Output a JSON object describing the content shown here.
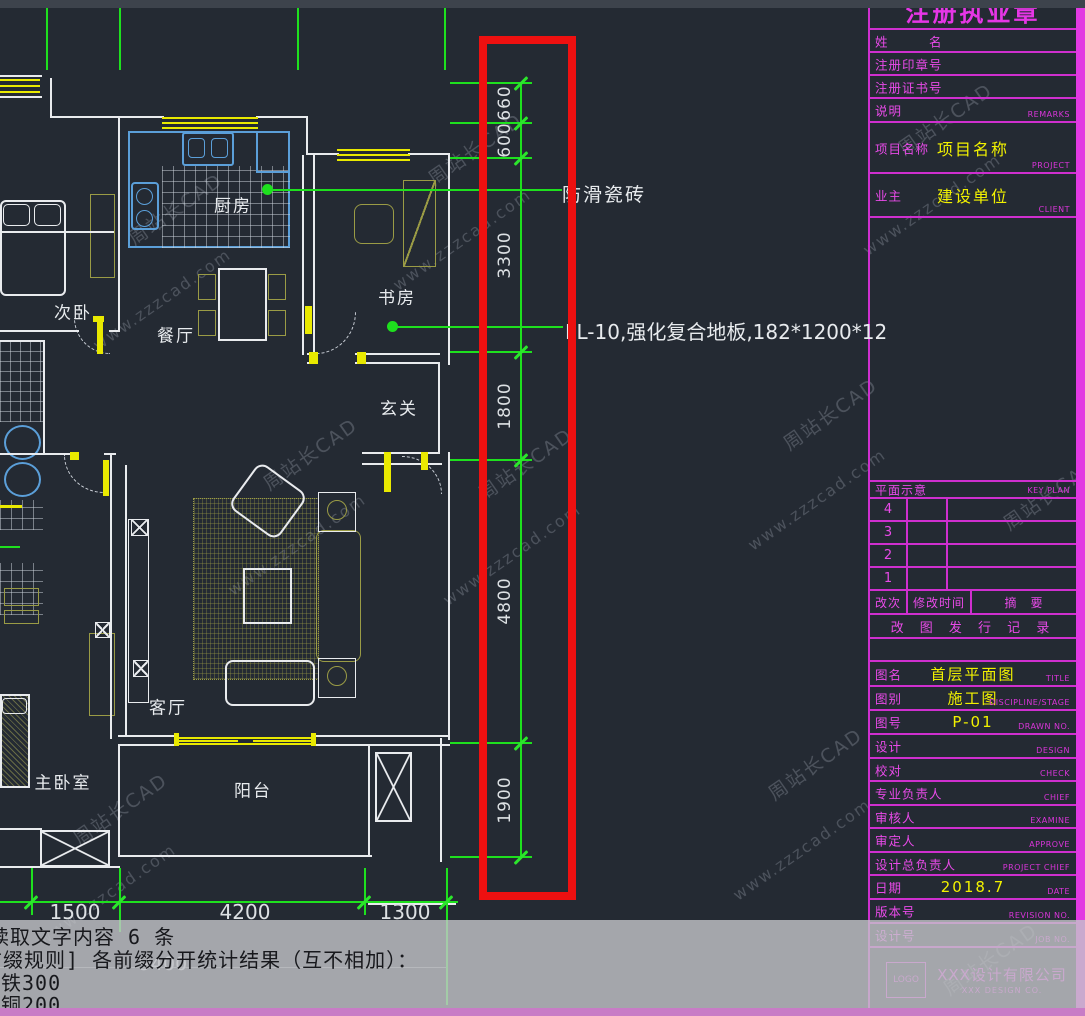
{
  "watermark": {
    "cn": "周站长CAD",
    "url": "www.zzzcad.com"
  },
  "plan": {
    "room_labels": [
      "厨房",
      "次卧",
      "餐厅",
      "书房",
      "玄关",
      "客厅",
      "主卧室",
      "阳台"
    ],
    "annotations": {
      "tile": "防滑瓷砖",
      "floor": "FL-10,强化复合地板,182*1200*12"
    }
  },
  "dims": {
    "vertical": [
      "660",
      "600",
      "3300",
      "1800",
      "4800",
      "1900"
    ],
    "bottom": [
      "1500",
      "4200",
      "1300"
    ],
    "overall": "9400"
  },
  "titleblock": {
    "header": "注册执业章",
    "name_label": "姓　　　名",
    "seal_label": "注册印章号",
    "cert_label": "注册证书号",
    "remarks_label": "说明",
    "remarks_en": "REMARKS",
    "project_label": "项目名称",
    "project_value": "项目名称",
    "project_en": "PROJECT",
    "client_label": "业主",
    "client_value": "建设单位",
    "client_en": "CLIENT",
    "keyplan_label": "平面示意",
    "keyplan_en": "KEY PLAN",
    "keyplan_rows": [
      "4",
      "3",
      "2",
      "1"
    ],
    "rev_col1": "改次",
    "rev_col2": "修改时间",
    "rev_col3": "摘　要",
    "revlog": "改 图 发 行 记 录",
    "title_label": "图名",
    "title_value": "首层平面图",
    "title_en": "TITLE",
    "stage_label": "图别",
    "stage_value": "施工图",
    "stage_en": "DISCIPLINE/STAGE",
    "dwg_label": "图号",
    "dwg_value": "P-01",
    "dwg_en": "DRAWN NO.",
    "design_label": "设计",
    "design_en": "DESIGN",
    "check_label": "校对",
    "check_en": "CHECK",
    "chief_label": "专业负责人",
    "chief_en": "CHIEF",
    "examine_label": "审核人",
    "examine_en": "EXAMINE",
    "approve_label": "审定人",
    "approve_en": "APPROVE",
    "projchief_label": "设计总负责人",
    "projchief_en": "PROJECT CHIEF",
    "date_label": "日期",
    "date_value": "2018.7",
    "date_en": "DATE",
    "revision_label": "版本号",
    "revision_en": "REVISION NO.",
    "job_label": "设计号",
    "job_en": "JOB NO.",
    "logo": "LOGO",
    "company": "XXX设计有限公司",
    "company_en": "XXX DESIGN CO."
  },
  "console": {
    "lines": [
      "读取文字内容 6 条",
      "[前缀规则] 各前缀分开统计结果（互不相加）：",
      "铁300",
      "铜200"
    ]
  }
}
